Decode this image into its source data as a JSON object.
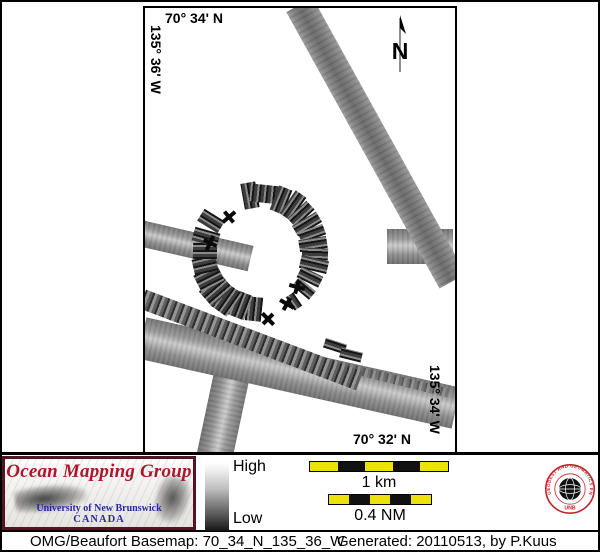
{
  "map": {
    "top_lat": "70° 34' N",
    "left_lon": "135° 36' W",
    "right_lon": "135° 34' W",
    "bottom_lat": "70° 32' N",
    "north_label": "N",
    "tracks": {
      "bands": [
        {
          "cx": 83,
          "cy": 385,
          "len": 130,
          "w": 36,
          "rot": 102,
          "cls": ""
        },
        {
          "cx": 154,
          "cy": 365,
          "len": 322,
          "w": 42,
          "rot": 12.6,
          "cls": ""
        },
        {
          "cx": 106,
          "cy": 332,
          "len": 232,
          "w": 20,
          "rot": 20.7,
          "cls": "hatch"
        },
        {
          "cx": 245,
          "cy": 370,
          "len": 120,
          "w": 9,
          "rot": 14,
          "cls": "hatch dim"
        },
        {
          "cx": 51,
          "cy": 238,
          "len": 112,
          "w": 26,
          "rot": 13,
          "cls": ""
        },
        {
          "cx": 275,
          "cy": 238,
          "len": 66,
          "w": 35,
          "rot": 0,
          "cls": ""
        },
        {
          "cx": 231,
          "cy": 135,
          "len": 316,
          "w": 30,
          "rot": 61,
          "cls": "plain"
        }
      ],
      "ring": {
        "cx": 115,
        "cy": 244,
        "segments": [
          {
            "a": -100,
            "r": 57,
            "w": 26,
            "h": 15
          },
          {
            "a": -84,
            "r": 58,
            "w": 18,
            "h": 32
          },
          {
            "a": -68,
            "r": 56,
            "w": 26,
            "h": 14
          },
          {
            "a": -55,
            "r": 57,
            "w": 28,
            "h": 13
          },
          {
            "a": -43,
            "r": 56,
            "w": 26,
            "h": 12
          },
          {
            "a": -31,
            "r": 55,
            "w": 28,
            "h": 12
          },
          {
            "a": -20,
            "r": 55,
            "w": 26,
            "h": 11
          },
          {
            "a": -9,
            "r": 54,
            "w": 28,
            "h": 12
          },
          {
            "a": 2,
            "r": 55,
            "w": 26,
            "h": 12
          },
          {
            "a": 13,
            "r": 55,
            "w": 28,
            "h": 13
          },
          {
            "a": 26,
            "r": 56,
            "w": 24,
            "h": 12
          },
          {
            "a": 40,
            "r": 57,
            "w": 22,
            "h": 11
          },
          {
            "a": 56,
            "r": 60,
            "w": 16,
            "h": 9
          },
          {
            "a": 96,
            "r": 57,
            "w": 24,
            "h": 16
          },
          {
            "a": 111,
            "r": 57,
            "w": 26,
            "h": 18
          },
          {
            "a": 125,
            "r": 58,
            "w": 28,
            "h": 18
          },
          {
            "a": 139,
            "r": 58,
            "w": 28,
            "h": 20
          },
          {
            "a": 153,
            "r": 57,
            "w": 26,
            "h": 18
          },
          {
            "a": 167,
            "r": 56,
            "w": 24,
            "h": 16
          },
          {
            "a": 181,
            "r": 55,
            "w": 24,
            "h": 16
          },
          {
            "a": 196,
            "r": 56,
            "w": 26,
            "h": 14
          },
          {
            "a": 212,
            "r": 58,
            "w": 24,
            "h": 14
          }
        ],
        "extra_bars": [
          {
            "x": 190,
            "y": 338,
            "w": 22,
            "h": 10,
            "rot": 18
          },
          {
            "x": 206,
            "y": 347,
            "w": 22,
            "h": 10,
            "rot": 14
          }
        ]
      },
      "glyphs": [
        {
          "x": 84,
          "y": 209,
          "rot": -40
        },
        {
          "x": 65,
          "y": 235,
          "rot": -65
        },
        {
          "x": 152,
          "y": 279,
          "rot": 15
        },
        {
          "x": 142,
          "y": 296,
          "rot": 30
        },
        {
          "x": 123,
          "y": 311,
          "rot": 45
        }
      ]
    }
  },
  "legend": {
    "omg": {
      "title": "Ocean Mapping Group",
      "line1": "University of New Brunswick",
      "line2": "CANADA",
      "title_color": "#a8192b",
      "text_color": "#2a2aa0"
    },
    "colorbar": {
      "high": "High",
      "low": "Low"
    },
    "scalebars": [
      {
        "label": "1 km",
        "x": 309,
        "y": 461,
        "w": 140,
        "h": 11,
        "segments": 5
      },
      {
        "label": "0.4 NM",
        "x": 328,
        "y": 494,
        "w": 104,
        "h": 11,
        "segments": 5
      }
    ],
    "scalebar_colors": [
      "#ede10a",
      "#111111"
    ],
    "seal": {
      "ring_text": "GEODESY AND GEOMATICS ENGINEERING",
      "bottom_text": "UNB",
      "color": "#c42127"
    }
  },
  "statusbar": {
    "left": "OMG/Beaufort Basemap: 70_34_N_135_36_W",
    "right": "Generated: 20110513, by P.Kuus"
  }
}
